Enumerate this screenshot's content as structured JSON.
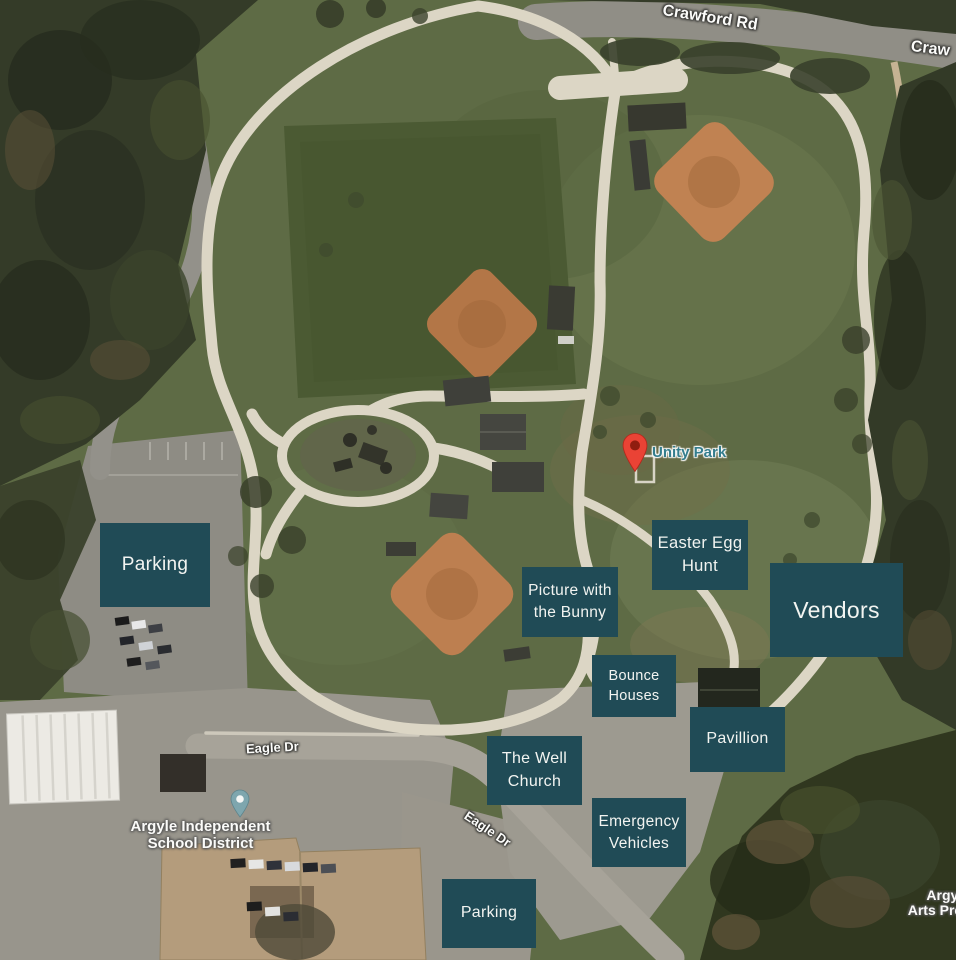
{
  "colors": {
    "overlay_bg": "#204b56",
    "overlay_text": "#f2f4f1",
    "pin_red": "#ea4335",
    "pin_red_inner": "#8f1d10",
    "school_pin": "#7ea6ae",
    "park_label_text": "#347d8d"
  },
  "overlays": [
    {
      "id": "parking-northwest",
      "label": "Parking"
    },
    {
      "id": "picture-with-the-bunny",
      "label": "Picture with the Bunny"
    },
    {
      "id": "easter-egg-hunt",
      "label": "Easter Egg Hunt"
    },
    {
      "id": "vendors",
      "label": "Vendors"
    },
    {
      "id": "bounce-houses",
      "label": "Bounce Houses"
    },
    {
      "id": "pavillion",
      "label": "Pavillion"
    },
    {
      "id": "the-well-church",
      "label": "The Well Church"
    },
    {
      "id": "emergency-vehicles",
      "label": "Emergency Vehicles"
    },
    {
      "id": "parking-south",
      "label": "Parking"
    }
  ],
  "map_labels": {
    "crawford_rd": "Crawford Rd",
    "crawford_rd_partial": "Craw",
    "eagle_dr": "Eagle Dr",
    "unity_park": "Unity Park",
    "school_line1": "Argyle Independent",
    "school_line2": "School District",
    "arts_line1": "Argyle",
    "arts_line2": "Arts Pres"
  }
}
